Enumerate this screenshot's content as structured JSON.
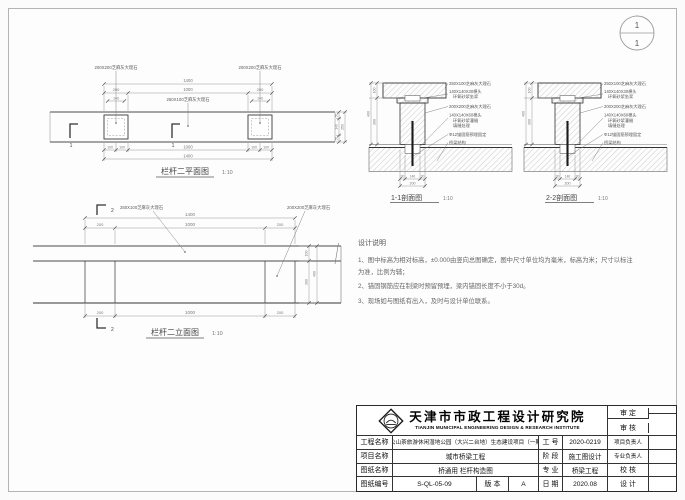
{
  "sheet_index": {
    "top": "1",
    "bottom": "1"
  },
  "plan": {
    "title": "栏杆二平面图",
    "scale": "1:10",
    "post_label": "200X200芝麻灰大理石",
    "rail_label": "250X100芝麻灰大理石",
    "cut_mark": "1",
    "dims": {
      "total_top": "1400",
      "left": "200",
      "mid": "1000",
      "right": "200",
      "tenon": "140",
      "b100a": "100",
      "b100b": "100",
      "bmid": "1000",
      "b100c": "100",
      "b100d": "100",
      "total_bottom": "1400",
      "side_a": "55",
      "side_b": "140",
      "side_c": "55",
      "side_total": "250"
    }
  },
  "sections": {
    "scale": "1:10",
    "titles": [
      "1-1剖面图",
      "2-2剖面图"
    ],
    "labels": {
      "rail": "250X100芝麻灰大理石",
      "tenon_top": "140X140X30榫头",
      "mortar_top": "环氧砂浆坐浆",
      "post": "200X200芝麻灰大理石",
      "tenon_bot": "140X140X60榫头",
      "mortar_bot": "环氧砂浆灌缝",
      "joint": "填缝处理",
      "rebar": "Φ12锚固筋预埋固定",
      "deck": "桥梁结构"
    },
    "dims": {
      "rail_h": "100",
      "post_h": "300",
      "total_h": "400",
      "edge_l": "30",
      "tenon": "140",
      "edge_r": "30",
      "post_w": "200"
    }
  },
  "elevation": {
    "title": "栏杆二立面图",
    "scale": "1:10",
    "rail_label": "250X100芝麻灰大理石",
    "post_label": "200X200芝麻灰大理石",
    "cut_mark": "2",
    "dims": {
      "total": "1400",
      "left": "200",
      "mid": "1000",
      "right": "200",
      "b_left": "200",
      "b_mid": "1000",
      "b_right": "200",
      "rail_h": "100",
      "post_h": "300",
      "total_h": "400"
    }
  },
  "notes": {
    "title": "设计说明",
    "items": [
      "1、图中标高为相对标高，±0.000由竖向总图确定，图中尺寸单位均为毫米，标高为米；尺寸以标注为准，比例为辅；",
      "2、锚固钢筋应在制梁时预留预埋，梁内锚固长度不小于30d。",
      "3、现场如与图纸有出入，及时与设计单位联系。"
    ]
  },
  "titleblock": {
    "institute_cn": "天津市市政工程设计研究院",
    "institute_en": "TIANJIN MUNICIPAL ENGINEERING DESIGN & RESEARCH INSTITUTE",
    "approve_label": "审  定",
    "review_label": "审  核",
    "project_label": "工程名称",
    "project_value": "周公山茶旅游休闲湿地公园（大兴二台地）生态建设项目（一期）",
    "jobno_label": "工  号",
    "jobno_value": "2020-0219",
    "pm_label": "项目负责人",
    "item_label": "项目名称",
    "item_value": "城市桥梁工程",
    "stage_label": "阶  段",
    "stage_value": "施工图设计",
    "lead_label": "专业负责人",
    "sheetname_label": "图纸名称",
    "sheetname_value": "桥通用 栏杆构造图",
    "major_label": "专  业",
    "major_value": "桥梁工程",
    "check_label": "校  核",
    "sheetno_label": "图纸编号",
    "sheetno_value": "S-QL-05-09",
    "version_label": "版  本",
    "version_value": "A",
    "date_label": "日  期",
    "date_value": "2020.08",
    "design_label": "设  计"
  }
}
